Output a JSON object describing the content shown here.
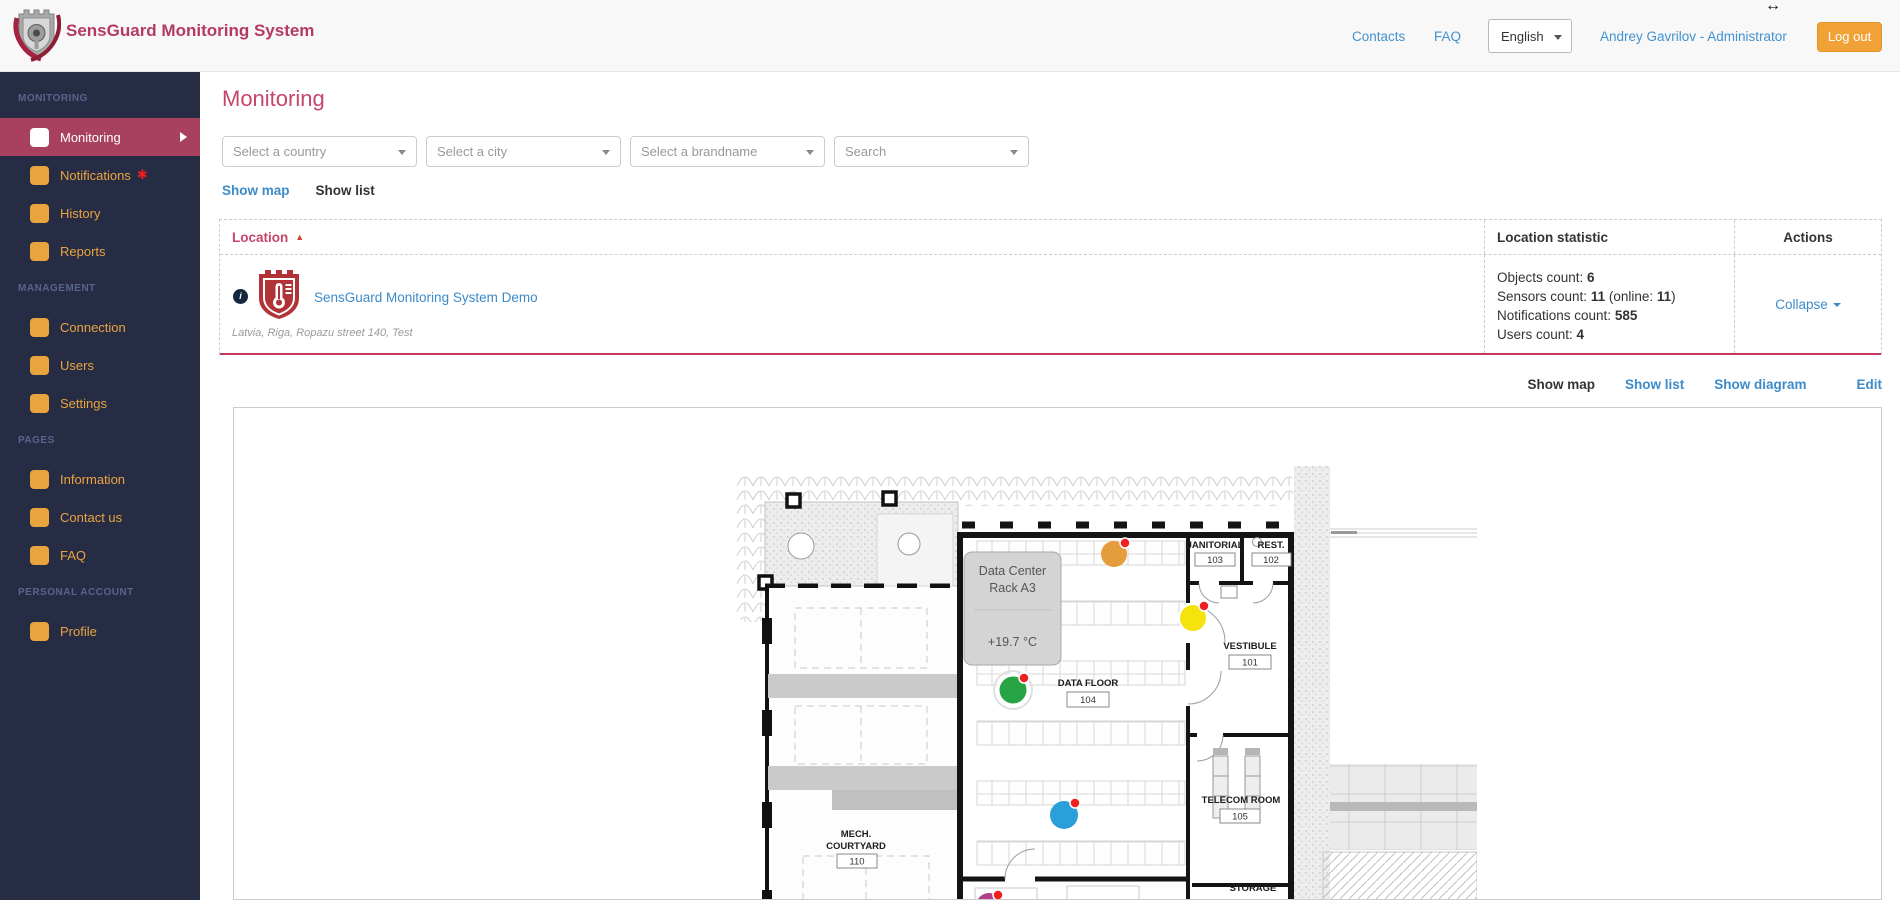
{
  "icons": {
    "sort_asc": "▲",
    "asterisk": "✱",
    "info": "i",
    "resize_cursor": "↔"
  },
  "colors": {
    "sensor_alert": "#ee2020"
  },
  "header": {
    "brand": "SensGuard Monitoring System",
    "contacts": "Contacts",
    "faq": "FAQ",
    "language": "English",
    "user": "Andrey Gavrilov - Administrator",
    "logout": "Log out"
  },
  "sidebar": {
    "sections": [
      {
        "title": "MONITORING",
        "items": [
          {
            "label": "Monitoring"
          },
          {
            "label": "Notifications"
          },
          {
            "label": "History"
          },
          {
            "label": "Reports"
          }
        ]
      },
      {
        "title": "MANAGEMENT",
        "items": [
          {
            "label": "Connection"
          },
          {
            "label": "Users"
          },
          {
            "label": "Settings"
          }
        ]
      },
      {
        "title": "PAGES",
        "items": [
          {
            "label": "Information"
          },
          {
            "label": "Contact us"
          },
          {
            "label": "FAQ"
          }
        ]
      },
      {
        "title": "PERSONAL ACCOUNT",
        "items": [
          {
            "label": "Profile"
          }
        ]
      }
    ]
  },
  "main": {
    "title": "Monitoring",
    "filters": [
      {
        "placeholder": "Select a country"
      },
      {
        "placeholder": "Select a city"
      },
      {
        "placeholder": "Select a brandname"
      },
      {
        "placeholder": "Search"
      }
    ],
    "toggle": {
      "show_map": "Show map",
      "show_list": "Show list"
    },
    "table": {
      "col_location": "Location",
      "col_statistic": "Location statistic",
      "col_actions": "Actions",
      "row": {
        "name": "SensGuard Monitoring System Demo",
        "address": "Latvia, Riga, Ropazu street 140, Test",
        "stats": [
          {
            "label": "Objects count: ",
            "value": "6"
          },
          {
            "label": "Sensors count: ",
            "value": "11",
            "mid": " (online: ",
            "value2": "11",
            "rest": ")"
          },
          {
            "label": "Notifications count: ",
            "value": "585"
          },
          {
            "label": "Users count: ",
            "value": "4"
          }
        ],
        "action": "Collapse"
      }
    },
    "row_links": {
      "show_map": "Show map",
      "show_list": "Show list",
      "show_diagram": "Show diagram",
      "edit": "Edit"
    },
    "map": {
      "tooltip": {
        "line1": "Data Center",
        "line2": "Rack A3",
        "temp": "+19.7 °C"
      },
      "rooms": [
        {
          "name": "JANITORIAL",
          "number": "103"
        },
        {
          "name": "REST.",
          "number": "102"
        },
        {
          "name": "VESTIBULE",
          "number": "101"
        },
        {
          "name": "DATA FLOOR",
          "number": "104"
        },
        {
          "name": "TELECOM ROOM",
          "number": "105"
        },
        {
          "name_line1": "MECH.",
          "name_line2": "COURTYARD",
          "number": "110"
        },
        {
          "name": "STORAGE"
        }
      ],
      "sensors": [
        {
          "name": "sensor-orange",
          "color": "#e59c3c"
        },
        {
          "name": "sensor-yellow",
          "color": "#f4e30c"
        },
        {
          "name": "sensor-green",
          "color": "#27a545"
        },
        {
          "name": "sensor-blue",
          "color": "#2b9fd9"
        },
        {
          "name": "sensor-magenta",
          "color": "#b23f88"
        }
      ]
    }
  }
}
